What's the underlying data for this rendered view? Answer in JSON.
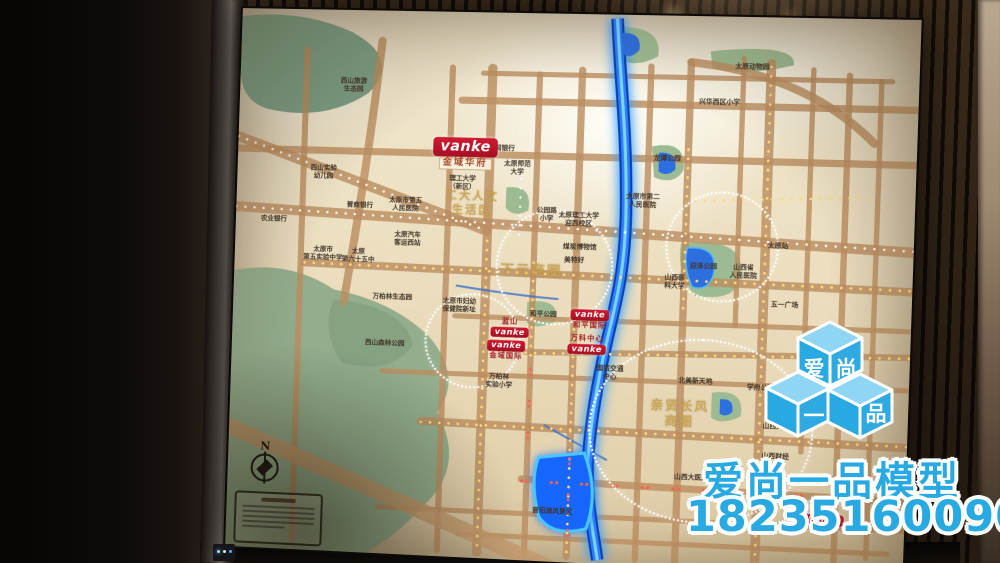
{
  "watermark": {
    "brand": "爱尚一品模型",
    "phone": "18235160090",
    "color": "#29A9E2",
    "cube_faces": {
      "top_left": "爱",
      "top_right": "尚",
      "bottom_left": "一",
      "bottom_right": "品"
    }
  },
  "map": {
    "compass": "N",
    "vanke_logo": "vanke",
    "colors": {
      "river": "#2f7dff",
      "lake": "#1766ff",
      "park": "#93ad8d",
      "road": "#bb8d60",
      "led_gold": "#ffd97a",
      "led_white": "#ffffff",
      "led_red": "#ff5f52",
      "vanke_red": "#c8102e",
      "gold_text": "#c9a24f"
    },
    "gold_labels": [
      {
        "t": "工大人文\n生活区",
        "x": 233,
        "y": 188,
        "s": 11
      },
      {
        "t": "下元商圈",
        "x": 293,
        "y": 254,
        "s": 13
      },
      {
        "t": "亲贤长风\n商圈",
        "x": 440,
        "y": 388,
        "s": 12
      }
    ],
    "labels": [
      {
        "t": "西山旅游\n生态园",
        "x": 113,
        "y": 75
      },
      {
        "t": "兴华西区小学",
        "x": 468,
        "y": 84
      },
      {
        "t": "太原动物园",
        "x": 498,
        "y": 49
      },
      {
        "t": "西山实验\n幼儿园",
        "x": 86,
        "y": 162
      },
      {
        "t": "晋商银行",
        "x": 123,
        "y": 194
      },
      {
        "t": "农业银行",
        "x": 38,
        "y": 210
      },
      {
        "t": "太原市第五\n人民医院",
        "x": 168,
        "y": 192
      },
      {
        "t": "太原汽车\n客运西站",
        "x": 171,
        "y": 226
      },
      {
        "t": "太原市\n第五实验中学",
        "x": 88,
        "y": 243
      },
      {
        "t": "太原\n第六十五中",
        "x": 123,
        "y": 244
      },
      {
        "t": "中国银行",
        "x": 260,
        "y": 134
      },
      {
        "t": "太原师范\n大学",
        "x": 276,
        "y": 153
      },
      {
        "t": "理工大学\n（新区）",
        "x": 223,
        "y": 169
      },
      {
        "t": "公园路\n小学",
        "x": 306,
        "y": 198
      },
      {
        "t": "太原理工大学\n迎西校区",
        "x": 337,
        "y": 202
      },
      {
        "t": "太原市第二\n人民医院",
        "x": 398,
        "y": 182
      },
      {
        "t": "龙潭公园",
        "x": 420,
        "y": 140
      },
      {
        "t": "煤炭博物馆",
        "x": 339,
        "y": 229
      },
      {
        "t": "美特好",
        "x": 334,
        "y": 242
      },
      {
        "t": "山西医\n科大学",
        "x": 431,
        "y": 260
      },
      {
        "t": "山西省\n人民医院",
        "x": 496,
        "y": 248
      },
      {
        "t": "太原站",
        "x": 528,
        "y": 222
      },
      {
        "t": "五一广场",
        "x": 536,
        "y": 279
      },
      {
        "t": "迎泽公园",
        "x": 458,
        "y": 244
      },
      {
        "t": "和平公园",
        "x": 306,
        "y": 296
      },
      {
        "t": "万柏林生态园",
        "x": 158,
        "y": 284
      },
      {
        "t": "西山森林公园",
        "x": 152,
        "y": 330
      },
      {
        "t": "太原市妇幼\n保健院新址",
        "x": 224,
        "y": 290
      },
      {
        "t": "万柏林\n实验小学",
        "x": 265,
        "y": 363
      },
      {
        "t": "国贸交通\n中心",
        "x": 372,
        "y": 351
      },
      {
        "t": "北美新天地",
        "x": 454,
        "y": 356
      },
      {
        "t": "学府公园",
        "x": 516,
        "y": 360
      },
      {
        "t": "山西大学",
        "x": 532,
        "y": 397
      },
      {
        "t": "山西财经\n大学",
        "x": 532,
        "y": 430
      },
      {
        "t": "山西大医院",
        "x": 453,
        "y": 450
      },
      {
        "t": "晋阳湖风景区",
        "x": 321,
        "y": 489
      },
      {
        "t": "北营车站",
        "x": 576,
        "y": 447
      }
    ],
    "vanke_markers": [
      {
        "x": 225,
        "y": 140,
        "big": true,
        "sub": "金域华府",
        "plaque": true
      },
      {
        "x": 274,
        "y": 310,
        "sub": "蓝山",
        "above": true
      },
      {
        "x": 271,
        "y": 332,
        "sub": "金域国际"
      },
      {
        "x": 351,
        "y": 299,
        "sub": "和平国际"
      },
      {
        "x": 349,
        "y": 324,
        "sub": "万科中心",
        "above": true
      },
      {
        "x": 551,
        "y": 358
      },
      {
        "x": 580,
        "y": 485
      }
    ],
    "district_circles": [
      {
        "x": 313,
        "y": 247,
        "rx": 55,
        "ry": 55
      },
      {
        "x": 473,
        "y": 222,
        "rx": 52,
        "ry": 52
      },
      {
        "x": 458,
        "y": 402,
        "rx": 105,
        "ry": 88
      },
      {
        "x": 236,
        "y": 322,
        "rx": 45,
        "ry": 45
      }
    ]
  }
}
